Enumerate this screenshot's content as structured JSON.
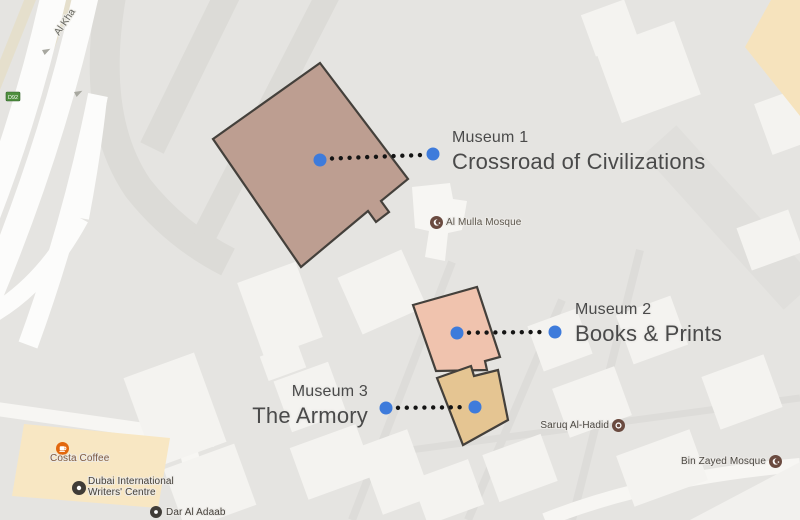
{
  "map": {
    "road_label": "Al Kha",
    "route_badge": "D92",
    "colors": {
      "marker_blue": "#3e7bdb",
      "leader_dot": "#141414",
      "museum1_fill": "#bd9e91",
      "museum2_fill": "#f0c3ae",
      "museum3_fill": "#e5c592",
      "building_outline": "#44403b",
      "commercial_area": "#f8e7c3",
      "mosque_icon": "#6a4a3f",
      "cafe_icon": "#e2670d",
      "landmark_icon": "#403c37"
    }
  },
  "annotations": {
    "m1": {
      "label": "Museum 1",
      "name": "Crossroad of Civilizations"
    },
    "m2": {
      "label": "Museum 2",
      "name": "Books & Prints"
    },
    "m3": {
      "label": "Museum 3",
      "name": "The Armory"
    }
  },
  "pois": {
    "alMulla": {
      "name": "Al Mulla Mosque"
    },
    "saruq": {
      "name": "Saruq Al-Hadid"
    },
    "binZayed": {
      "name": "Bin Zayed Mosque"
    },
    "costa": {
      "name": "Costa Coffee"
    },
    "writers": {
      "line1": "Dubai International",
      "line2": "Writers' Centre"
    },
    "darAlAdaab": {
      "name": "Dar Al Adaab"
    }
  }
}
